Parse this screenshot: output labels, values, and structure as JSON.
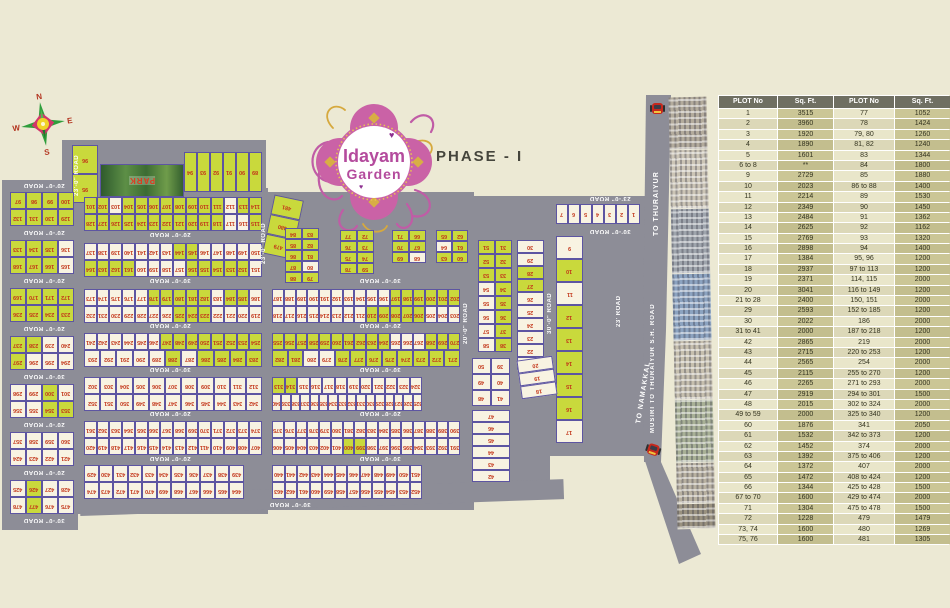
{
  "title": {
    "logo_line1": "Idayam",
    "logo_line2": "Garden",
    "phase": "PHASE - I",
    "park": "PARK"
  },
  "compass": {
    "n": "N",
    "e": "E",
    "s": "S",
    "w": "W"
  },
  "highway": {
    "to_thuraiyur": "TO THURAIYUR",
    "main_road": "MUSIRI TO THURAIYUR S.H. ROAD",
    "to_namakkal": "TO NAMAKKAL"
  },
  "colors": {
    "plot_sold": "#c9d93c",
    "plot_open": "#f8f3e2",
    "road": "#8d8d97",
    "number": "#c23418",
    "accent_pink": "#c7619f"
  },
  "road_labels": [
    {
      "t": "20'-0\" ROAD",
      "x": 14,
      "y": 182,
      "o": "h",
      "w": 60
    },
    {
      "t": "20'-0\" ROAD",
      "x": 14,
      "y": 229,
      "o": "h",
      "w": 60
    },
    {
      "t": "20'-0\" ROAD",
      "x": 14,
      "y": 277,
      "o": "h",
      "w": 60
    },
    {
      "t": "20'-0\" ROAD",
      "x": 14,
      "y": 325,
      "o": "h",
      "w": 60
    },
    {
      "t": "30'-0\" ROAD",
      "x": 14,
      "y": 373,
      "o": "h",
      "w": 60
    },
    {
      "t": "20'-0\" ROAD",
      "x": 14,
      "y": 421,
      "o": "h",
      "w": 60
    },
    {
      "t": "20'-0\" ROAD",
      "x": 14,
      "y": 469,
      "o": "h",
      "w": 60
    },
    {
      "t": "30'-0\" ROAD",
      "x": 14,
      "y": 517,
      "o": "h",
      "w": 60
    },
    {
      "t": "20'-0\" ROAD",
      "x": 120,
      "y": 231,
      "o": "h",
      "w": 100
    },
    {
      "t": "30'-0\" ROAD",
      "x": 120,
      "y": 277,
      "o": "h",
      "w": 100
    },
    {
      "t": "20'-0\" ROAD",
      "x": 120,
      "y": 322,
      "o": "h",
      "w": 100
    },
    {
      "t": "30'-0\" ROAD",
      "x": 120,
      "y": 366,
      "o": "h",
      "w": 100
    },
    {
      "t": "20'-0\" ROAD",
      "x": 120,
      "y": 410,
      "o": "h",
      "w": 100
    },
    {
      "t": "20'-0\" ROAD",
      "x": 120,
      "y": 455,
      "o": "h",
      "w": 100
    },
    {
      "t": "30'-0\" ROAD",
      "x": 240,
      "y": 501,
      "o": "h",
      "w": 100
    },
    {
      "t": "30'-0\" ROAD",
      "x": 330,
      "y": 277,
      "o": "h",
      "w": 100
    },
    {
      "t": "20'-0\" ROAD",
      "x": 330,
      "y": 322,
      "o": "h",
      "w": 100
    },
    {
      "t": "30'-0\" ROAD",
      "x": 330,
      "y": 366,
      "o": "h",
      "w": 100
    },
    {
      "t": "20'-0\" ROAD",
      "x": 330,
      "y": 410,
      "o": "h",
      "w": 100
    },
    {
      "t": "30'-0\" ROAD",
      "x": 330,
      "y": 455,
      "o": "h",
      "w": 100
    },
    {
      "t": "23'-0\" ROAD",
      "x": 74,
      "y": 148,
      "o": "v",
      "h": 55
    },
    {
      "t": "23'-0\" ROAD",
      "x": 261,
      "y": 212,
      "o": "v",
      "h": 62
    },
    {
      "t": "20'-0\" ROAD",
      "x": 463,
      "y": 288,
      "o": "v",
      "h": 70
    },
    {
      "t": "30'-0\" ROAD",
      "x": 547,
      "y": 278,
      "o": "v",
      "h": 70
    },
    {
      "t": "23'-0\" ROAD",
      "x": 575,
      "y": 195,
      "o": "h",
      "w": 70
    },
    {
      "t": "30'-0\" ROAD",
      "x": 575,
      "y": 228,
      "o": "h",
      "w": 70
    },
    {
      "t": "23' ROAD",
      "x": 616,
      "y": 286,
      "o": "v",
      "h": 50
    }
  ],
  "blocks": [
    {
      "x": 72,
      "y": 145,
      "cw": 26,
      "ch": 29,
      "base": "g",
      "rows": [
        [
          96
        ],
        [
          95
        ]
      ]
    },
    {
      "x": 184,
      "y": 152,
      "cw": 13,
      "ch": 40,
      "base": "g",
      "rows": [
        [
          94,
          93,
          92,
          91,
          90,
          89
        ]
      ]
    },
    {
      "x": 268,
      "y": 197,
      "cw": 30,
      "ch": 20,
      "rot": 12,
      "base": "g",
      "rows": [
        [
          481
        ],
        [
          480
        ],
        [
          479
        ]
      ]
    },
    {
      "x": 84,
      "y": 197,
      "w": 178,
      "ch": 17,
      "base": "g",
      "alt": [
        103,
        112,
        117,
        116
      ],
      "rows": [
        "101-114",
        "128-115"
      ]
    },
    {
      "x": 84,
      "y": 243,
      "w": 178,
      "ch": 17,
      "base": "c",
      "alt": [
        144,
        145,
        164,
        163,
        162,
        161,
        156,
        155,
        154,
        153,
        152
      ],
      "rows": [
        "137-150",
        "164-151"
      ]
    },
    {
      "x": 84,
      "y": 289,
      "w": 178,
      "ch": 17,
      "base": "c",
      "alt": [
        178,
        179,
        180,
        181,
        182,
        184,
        185,
        225,
        224,
        223
      ],
      "rows": [
        "173-186",
        "232-219"
      ]
    },
    {
      "x": 272,
      "y": 289,
      "w": 188,
      "ch": 17,
      "base": "c",
      "alt": [
        197,
        198,
        199,
        200,
        201,
        202,
        206,
        207,
        208,
        209,
        210
      ],
      "rows": [
        "187-202",
        "218-203"
      ]
    },
    {
      "x": 84,
      "y": 333,
      "w": 178,
      "ch": 17,
      "base": "c",
      "alt": [
        247,
        248,
        249,
        250,
        251,
        252,
        253,
        254,
        283,
        284,
        285,
        286,
        288
      ],
      "rows": [
        "241-254",
        "293-283"
      ]
    },
    {
      "x": 272,
      "y": 333,
      "w": 188,
      "ch": 17,
      "base": "g",
      "alt": [
        265,
        266,
        267,
        280,
        279
      ],
      "rows": [
        "255-270",
        "282-271"
      ]
    },
    {
      "x": 84,
      "y": 377,
      "w": 178,
      "ch": 17,
      "base": "c",
      "rows": [
        "302-312",
        "352-342"
      ]
    },
    {
      "x": 272,
      "y": 377,
      "w": 150,
      "ch": 17,
      "base": "c",
      "alt": [
        313,
        314
      ],
      "rows": [
        "313-324",
        "340-325"
      ]
    },
    {
      "x": 84,
      "y": 421,
      "w": 178,
      "ch": 17,
      "base": "c",
      "rows": [
        "361-374",
        "420-407"
      ]
    },
    {
      "x": 272,
      "y": 421,
      "w": 188,
      "ch": 17,
      "base": "c",
      "alt": [
        399,
        400
      ],
      "rows": [
        "375-390",
        "406-391"
      ]
    },
    {
      "x": 84,
      "y": 465,
      "w": 160,
      "ch": 17,
      "base": "c",
      "rows": [
        "429-439",
        "474-464"
      ]
    },
    {
      "x": 272,
      "y": 465,
      "w": 150,
      "ch": 17,
      "base": "c",
      "rows": [
        "440-451",
        "463-452"
      ]
    },
    {
      "x": 10,
      "y": 192,
      "cw": 16,
      "ch": 17,
      "base": "g",
      "rows": [
        "97-100",
        "132-129"
      ]
    },
    {
      "x": 10,
      "y": 240,
      "cw": 16,
      "ch": 17,
      "base": "g",
      "alt": [
        136,
        165
      ],
      "rows": [
        "133-136",
        "168-165"
      ]
    },
    {
      "x": 10,
      "y": 288,
      "cw": 16,
      "ch": 17,
      "base": "g",
      "rows": [
        "169-172",
        "236-233"
      ]
    },
    {
      "x": 10,
      "y": 336,
      "cw": 16,
      "ch": 17,
      "base": "g",
      "alt": [
        239,
        240,
        296,
        295,
        294
      ],
      "rows": [
        "237-240",
        "297-294"
      ]
    },
    {
      "x": 10,
      "y": 384,
      "cw": 16,
      "ch": 17,
      "base": "c",
      "alt": [
        300,
        354,
        353
      ],
      "rows": [
        "298-301",
        "356-353"
      ]
    },
    {
      "x": 10,
      "y": 432,
      "cw": 16,
      "ch": 17,
      "base": "c",
      "rows": [
        "357-360",
        "424-421"
      ]
    },
    {
      "x": 10,
      "y": 480,
      "cw": 16,
      "ch": 17,
      "base": "c",
      "alt": [
        426,
        477
      ],
      "rows": [
        "425-428",
        "478-475"
      ]
    },
    {
      "x": 478,
      "y": 240,
      "cw": 17,
      "ch": 14,
      "base": "g",
      "alt": [
        54,
        55,
        56,
        57,
        58
      ],
      "rows": [
        [
          51,
          31
        ],
        [
          52,
          32
        ],
        [
          53,
          33
        ],
        [
          54,
          34
        ],
        [
          55,
          35
        ],
        [
          56,
          36
        ],
        [
          57,
          37
        ],
        [
          58,
          38
        ]
      ]
    },
    {
      "x": 517,
      "y": 240,
      "cw": 27,
      "ch": 13,
      "base": "c",
      "alt": [
        28,
        27
      ],
      "rows": [
        [
          30
        ],
        [
          29
        ],
        [
          28
        ],
        [
          27
        ],
        [
          26
        ],
        [
          25
        ],
        [
          24
        ],
        [
          23
        ],
        [
          22
        ],
        [
          21
        ]
      ]
    },
    {
      "x": 556,
      "y": 236,
      "cw": 27,
      "ch": 23,
      "base": "c",
      "alt": [
        10,
        12,
        13,
        14,
        15,
        16
      ],
      "rows": [
        [
          9
        ],
        [
          10
        ],
        [
          11
        ],
        [
          12
        ],
        [
          13
        ],
        [
          14
        ],
        [
          15
        ],
        [
          16
        ],
        [
          17
        ]
      ]
    },
    {
      "x": 556,
      "y": 204,
      "cw": 12,
      "ch": 20,
      "base": "c",
      "rows": [
        [
          7,
          6,
          5,
          4,
          3,
          2,
          1
        ]
      ]
    },
    {
      "x": 519,
      "y": 358,
      "cw": 36,
      "ch": 13,
      "rot": -8,
      "base": "c",
      "rows": [
        [
          20
        ],
        [
          19
        ],
        [
          18
        ]
      ]
    },
    {
      "x": 472,
      "y": 358,
      "cw": 19,
      "ch": 16,
      "base": "c",
      "rows": [
        [
          50,
          39
        ],
        [
          49,
          40
        ],
        [
          48,
          41
        ]
      ]
    },
    {
      "x": 472,
      "y": 410,
      "cw": 38,
      "ch": 12,
      "base": "c",
      "rows": [
        [
          47
        ],
        [
          46
        ],
        [
          45
        ],
        [
          44
        ],
        [
          43
        ],
        [
          42
        ]
      ]
    },
    {
      "x": 285,
      "y": 228,
      "cw": 17,
      "ch": 11,
      "base": "g",
      "alt": [
        80
      ],
      "rows": [
        [
          84,
          83
        ],
        [
          85,
          82
        ],
        [
          86,
          81
        ],
        [
          87,
          80
        ],
        [
          88,
          79
        ]
      ]
    },
    {
      "x": 340,
      "y": 230,
      "cw": 17,
      "ch": 11,
      "base": "g",
      "rows": [
        [
          77,
          72
        ],
        [
          76,
          73
        ],
        [
          75,
          74
        ],
        [
          78,
          59
        ]
      ]
    },
    {
      "x": 392,
      "y": 230,
      "cw": 17,
      "ch": 11,
      "base": "g",
      "alt": [
        68
      ],
      "rows": [
        [
          71,
          66
        ],
        [
          70,
          67
        ],
        [
          69,
          68
        ]
      ]
    },
    {
      "x": 436,
      "y": 230,
      "cw": 16,
      "ch": 11,
      "base": "g",
      "alt": [
        64
      ],
      "rows": [
        [
          65,
          62
        ],
        [
          64,
          61
        ],
        [
          63,
          60
        ]
      ]
    }
  ],
  "buildings": [
    {
      "h": 52,
      "c": "#b3ab9c"
    },
    {
      "h": 58,
      "c": "#cbc4b5"
    },
    {
      "h": 64,
      "c": "#9fa5ad"
    },
    {
      "h": 66,
      "c": "#8ca3c0"
    },
    {
      "h": 58,
      "c": "#c6bfae"
    },
    {
      "h": 62,
      "c": "#a8b096"
    },
    {
      "h": 40,
      "c": "#b8b1a1"
    },
    {
      "h": 24,
      "c": "#99917f"
    }
  ],
  "table": {
    "headers": [
      "PLOT No",
      "Sq. Ft.",
      "PLOT No",
      "Sq. Ft."
    ],
    "rows": [
      [
        "1",
        "3515",
        "77",
        "1052"
      ],
      [
        "2",
        "3960",
        "78",
        "1424"
      ],
      [
        "3",
        "1920",
        "79, 80",
        "1260"
      ],
      [
        "4",
        "1890",
        "81, 82",
        "1240"
      ],
      [
        "5",
        "1601",
        "83",
        "1344"
      ],
      [
        "6 to 8",
        "**",
        "84",
        "1800"
      ],
      [
        "9",
        "2729",
        "85",
        "1880"
      ],
      [
        "10",
        "2023",
        "86 to 88",
        "1400"
      ],
      [
        "11",
        "2214",
        "89",
        "1530"
      ],
      [
        "12",
        "2349",
        "90",
        "1450"
      ],
      [
        "13",
        "2484",
        "91",
        "1362"
      ],
      [
        "14",
        "2625",
        "92",
        "1162"
      ],
      [
        "15",
        "2769",
        "93",
        "1320"
      ],
      [
        "16",
        "2898",
        "94",
        "1400"
      ],
      [
        "17",
        "1384",
        "95, 96",
        "1200"
      ],
      [
        "18",
        "2937",
        "97 to 113",
        "1200"
      ],
      [
        "19",
        "2371",
        "114, 115",
        "2000"
      ],
      [
        "20",
        "3041",
        "116 to 149",
        "1200"
      ],
      [
        "21 to 28",
        "2400",
        "150, 151",
        "2000"
      ],
      [
        "29",
        "2593",
        "152 to 185",
        "1200"
      ],
      [
        "30",
        "2022",
        "186",
        "2000"
      ],
      [
        "31 to 41",
        "2000",
        "187 to 218",
        "1200"
      ],
      [
        "42",
        "2865",
        "219",
        "2000"
      ],
      [
        "43",
        "2715",
        "220 to 253",
        "1200"
      ],
      [
        "44",
        "2565",
        "254",
        "2000"
      ],
      [
        "45",
        "2115",
        "255 to 270",
        "1200"
      ],
      [
        "46",
        "2265",
        "271 to 293",
        "2000"
      ],
      [
        "47",
        "2919",
        "294 to 301",
        "1500"
      ],
      [
        "48",
        "2015",
        "302 to 324",
        "2000"
      ],
      [
        "49 to 59",
        "2000",
        "325 to 340",
        "1200"
      ],
      [
        "60",
        "1876",
        "341",
        "2050"
      ],
      [
        "61",
        "1532",
        "342 to 373",
        "1200"
      ],
      [
        "62",
        "1452",
        "374",
        "2000"
      ],
      [
        "63",
        "1392",
        "375 to 406",
        "1200"
      ],
      [
        "64",
        "1372",
        "407",
        "2000"
      ],
      [
        "65",
        "1472",
        "408 to 424",
        "1200"
      ],
      [
        "66",
        "1344",
        "425 to 428",
        "1500"
      ],
      [
        "67 to 70",
        "1600",
        "429 to 474",
        "2000"
      ],
      [
        "71",
        "1304",
        "475 to 478",
        "1500"
      ],
      [
        "72",
        "1228",
        "479",
        "1479"
      ],
      [
        "73, 74",
        "1600",
        "480",
        "1269"
      ],
      [
        "75, 76",
        "1600",
        "481",
        "1305"
      ]
    ]
  }
}
